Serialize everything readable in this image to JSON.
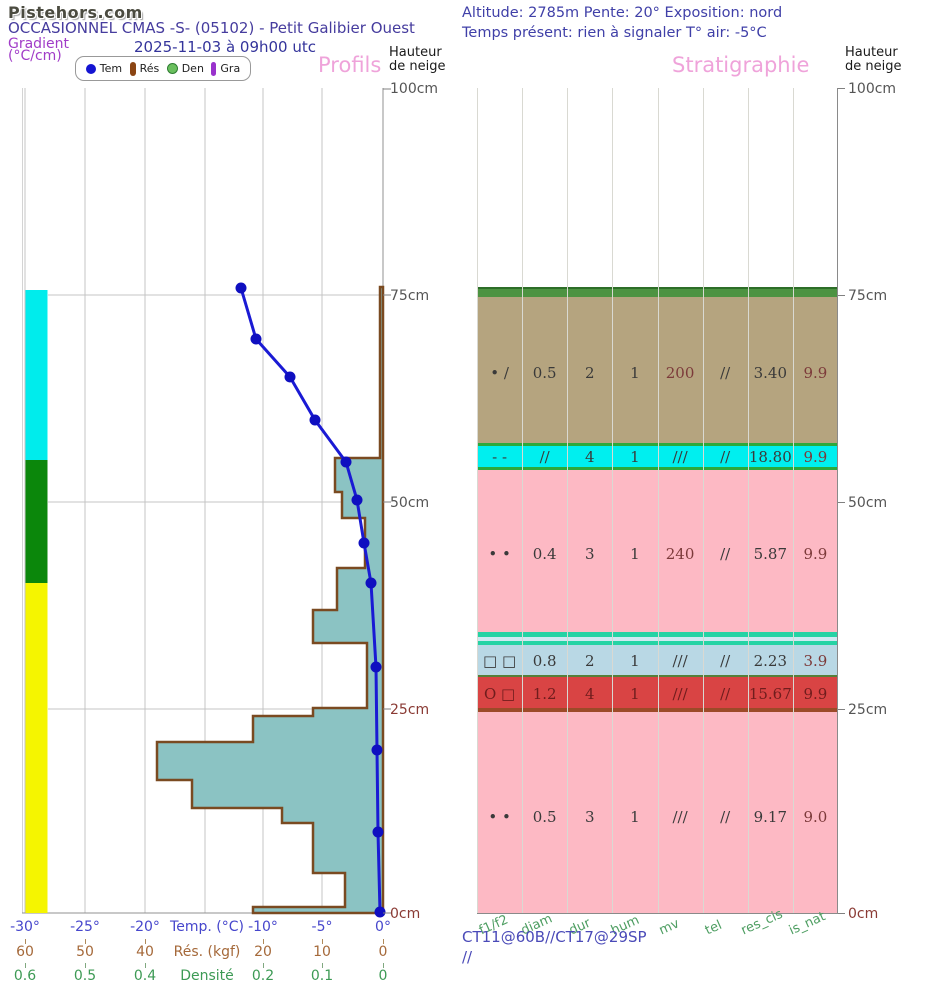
{
  "logo": "Pistehors.com",
  "header": {
    "title": "OCCASIONNEL CMAS -S- (05102) - Petit Galibier Ouest",
    "date": "2025-11-03 à 09h00 utc",
    "gradient1": "Gradient",
    "gradient2": "(°C/cm)",
    "altitude": "Altitude: 2785m Pente: 20° Exposition: nord",
    "weather": "Temps présent: rien à signaler T° air: -5°C"
  },
  "legend": {
    "tem": "Tem",
    "res": "Rés",
    "den": "Den",
    "gra": "Gra"
  },
  "panels": {
    "profils_heading": "Profils",
    "strat_heading": "Stratigraphie",
    "hauteur1": "Hauteur",
    "hauteur2": "de neige"
  },
  "height_ticks": {
    "h100": "100cm",
    "h75": "75cm",
    "h50": "50cm",
    "h25": "25cm",
    "h0": "0cm"
  },
  "x_axis": {
    "temp": {
      "t0": "-30°",
      "t1": "-25°",
      "t2": "-20°",
      "title": "Temp. (°C)",
      "t4": "-10°",
      "t5": "-5°",
      "t6": "0°"
    },
    "res": {
      "t0": "60",
      "t1": "50",
      "t2": "40",
      "title": "Rés. (kgf)",
      "t4": "20",
      "t5": "10",
      "t6": "0"
    },
    "den": {
      "t0": "0.6",
      "t1": "0.5",
      "t2": "0.4",
      "title": "Densité",
      "t4": "0.2",
      "t5": "0.1",
      "t6": "0"
    }
  },
  "strat": {
    "columns": {
      "c0": "f1/f2",
      "c1": "diam",
      "c2": "dur",
      "c3": "hum",
      "c4": "mv",
      "c5": "tel",
      "c6": "res_cis",
      "c7": "is_nat"
    },
    "rows": [
      {
        "cells": [
          "• /",
          "0.5",
          "2",
          "1",
          "200",
          "//",
          "3.40",
          "9.9"
        ]
      },
      {
        "cells": [
          "- -",
          "//",
          "4",
          "1",
          "///",
          "//",
          "18.80",
          "9.9"
        ]
      },
      {
        "cells": [
          "• •",
          "0.4",
          "3",
          "1",
          "240",
          "//",
          "5.87",
          "9.9"
        ]
      },
      {
        "cells": [
          "□ □",
          "0.8",
          "2",
          "1",
          "///",
          "//",
          "2.23",
          "3.9"
        ]
      },
      {
        "cells": [
          "O □",
          "1.2",
          "4",
          "1",
          "///",
          "//",
          "15.67",
          "9.9"
        ]
      },
      {
        "cells": [
          "• •",
          "0.5",
          "3",
          "1",
          "///",
          "//",
          "9.17",
          "9.0"
        ]
      }
    ]
  },
  "tests": {
    "line1": "CT11@60B//CT17@29SP",
    "line2": "//"
  },
  "colors": {
    "heading_pink": "#efa3da",
    "temp_line": "#1a1ad4",
    "resistance_fill": "#8bc3c3",
    "resistance_outline": "#7a4a21",
    "gradient_cyan": "#00ecec",
    "gradient_green": "#0b870b",
    "gradient_yellow": "#f5f500",
    "layer_tan": "#b5a47f",
    "layer_cyan": "#00efef",
    "layer_pink": "#fdb9c4",
    "layer_lightblue": "#b9d8e5",
    "layer_red": "#d94444",
    "layer_surface_green": "#4d9342",
    "turquoise_strip": "#25d3a4"
  },
  "chart_data": {
    "type": "line",
    "title": "Snow profile — Profils / Stratigraphie",
    "snow_height_cm": 76,
    "y_axis": {
      "label": "Hauteur de neige",
      "ticks_cm": [
        0,
        25,
        50,
        75,
        100
      ],
      "range": [
        0,
        100
      ]
    },
    "temperature_profile": {
      "x_range_c": [
        -30,
        0
      ],
      "points_h_cm_vs_t_c": [
        {
          "h": 76,
          "t": -11.9
        },
        {
          "h": 70,
          "t": -10.6
        },
        {
          "h": 65,
          "t": -7.8
        },
        {
          "h": 60,
          "t": -5.7
        },
        {
          "h": 55,
          "t": -3.1
        },
        {
          "h": 50,
          "t": -2.2
        },
        {
          "h": 45,
          "t": -1.6
        },
        {
          "h": 40,
          "t": -1.0
        },
        {
          "h": 30,
          "t": -0.6
        },
        {
          "h": 20,
          "t": -0.5
        },
        {
          "h": 10,
          "t": -0.4
        },
        {
          "h": 0,
          "t": -0.2
        }
      ]
    },
    "resistance_profile_kgf": {
      "x_range_kgf": [
        60,
        0
      ],
      "segments_top_bottom_kgf": [
        {
          "top": 76,
          "bottom": 55,
          "kgf": 0.5
        },
        {
          "top": 55,
          "bottom": 51,
          "kgf": 8
        },
        {
          "top": 51,
          "bottom": 48,
          "kgf": 7
        },
        {
          "top": 48,
          "bottom": 42,
          "kgf": 3
        },
        {
          "top": 42,
          "bottom": 37,
          "kgf": 7.6
        },
        {
          "top": 37,
          "bottom": 33,
          "kgf": 11.7
        },
        {
          "top": 33,
          "bottom": 25,
          "kgf": 2.7
        },
        {
          "top": 25,
          "bottom": 24,
          "kgf": 11.7
        },
        {
          "top": 24,
          "bottom": 21,
          "kgf": 21.8
        },
        {
          "top": 21,
          "bottom": 16,
          "kgf": 37.9
        },
        {
          "top": 16,
          "bottom": 13,
          "kgf": 32
        },
        {
          "top": 13,
          "bottom": 11,
          "kgf": 16.9
        },
        {
          "top": 11,
          "bottom": 5,
          "kgf": 11.7
        },
        {
          "top": 5,
          "bottom": 1,
          "kgf": 6.4
        },
        {
          "top": 1,
          "bottom": 0,
          "kgf": 21.8
        }
      ]
    },
    "gradient_bands": [
      {
        "from_cm": 76,
        "to_cm": 55,
        "color": "cyan"
      },
      {
        "from_cm": 55,
        "to_cm": 40,
        "color": "green"
      },
      {
        "from_cm": 40,
        "to_cm": 0,
        "color": "yellow"
      }
    ],
    "strat_layers": [
      {
        "from_cm": 76,
        "to_cm": 75,
        "color": "green",
        "f1f2": "",
        "diam": "",
        "dur": "",
        "hum": "",
        "mv": "",
        "tel": "",
        "res_cis": "",
        "is_nat": ""
      },
      {
        "from_cm": 75,
        "to_cm": 57,
        "color": "tan",
        "f1f2": "• /",
        "diam": "0.5",
        "dur": "2",
        "hum": "1",
        "mv": "200",
        "tel": "//",
        "res_cis": "3.40",
        "is_nat": "9.9"
      },
      {
        "from_cm": 56.5,
        "to_cm": 54,
        "color": "cyan",
        "f1f2": "- -",
        "diam": "//",
        "dur": "4",
        "hum": "1",
        "mv": "///",
        "tel": "//",
        "res_cis": "18.80",
        "is_nat": "9.9"
      },
      {
        "from_cm": 54,
        "to_cm": 34,
        "color": "pink",
        "f1f2": "• •",
        "diam": "0.4",
        "dur": "3",
        "hum": "1",
        "mv": "240",
        "tel": "//",
        "res_cis": "5.87",
        "is_nat": "9.9"
      },
      {
        "from_cm": 34,
        "to_cm": 33,
        "color": "turquoise-strips",
        "f1f2": "",
        "diam": "",
        "dur": "",
        "hum": "",
        "mv": "",
        "tel": "",
        "res_cis": "",
        "is_nat": ""
      },
      {
        "from_cm": 33,
        "to_cm": 29,
        "color": "lightblue",
        "f1f2": "□ □",
        "diam": "0.8",
        "dur": "2",
        "hum": "1",
        "mv": "///",
        "tel": "//",
        "res_cis": "2.23",
        "is_nat": "3.9"
      },
      {
        "from_cm": 29,
        "to_cm": 25,
        "color": "red",
        "f1f2": "O □",
        "diam": "1.2",
        "dur": "4",
        "hum": "1",
        "mv": "///",
        "tel": "//",
        "res_cis": "15.67",
        "is_nat": "9.9"
      },
      {
        "from_cm": 25,
        "to_cm": 0,
        "color": "pink",
        "f1f2": "• •",
        "diam": "0.5",
        "dur": "3",
        "hum": "1",
        "mv": "///",
        "tel": "//",
        "res_cis": "9.17",
        "is_nat": "9.0"
      }
    ],
    "stability_tests": "CT11@60B//CT17@29SP //"
  }
}
